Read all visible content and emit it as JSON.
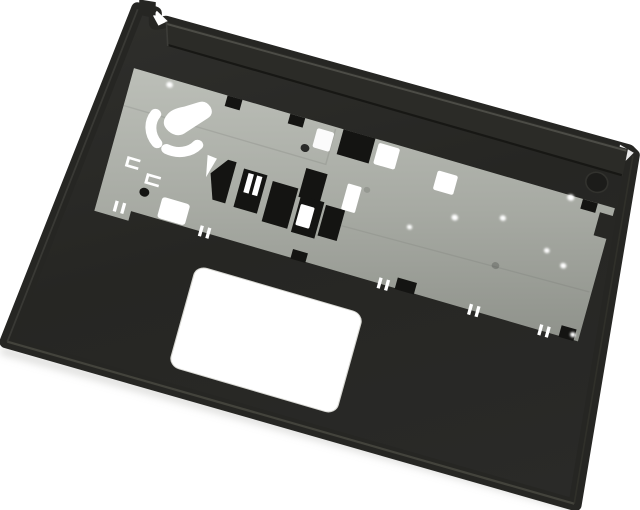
{
  "scene": {
    "alt_text": "Product photo of a black laptop palmrest top-cover assembly tilted about 16 degrees on a white background, showing a gray stamped-metal keyboard support plate with black and white cutouts, a boot-shaped cutout with two curved arc slots, screw holes, and a white rectangular touchpad opening",
    "subject": "laptop-palmrest-top-cover",
    "rotation_deg": 16.3,
    "colors": {
      "bg": "#ffffff",
      "body": "#262623",
      "body_light": "#2f2f2c",
      "body_dark": "#1e1e1c",
      "bar": "#2b2b27",
      "bar_highlight": "#50504a",
      "bar_shadow": "#141412",
      "plate_light": "#bcbfb8",
      "plate_mid": "#a7aaa3",
      "plate_dark": "#8d9089",
      "cutout": "#141412",
      "hole_white": "#ffffff",
      "edge_highlight": "#47473f",
      "shadow": "#c2c2bf"
    },
    "parts": {
      "body": "palmrest body (black plastic)",
      "ledge": "rear hinge ledge",
      "plate": "keyboard support plate (stamped metal)",
      "touchpad": "touchpad opening",
      "fan_cutout": "boot-shaped cutout with two arc slots",
      "square_cutout": "square through-hole",
      "round_recess": "round recess near top-right"
    },
    "counts": {
      "screw_dots": 8,
      "edge_slot_pairs": 5,
      "black_cutouts": 14,
      "white_cutouts": 8,
      "arc_slots": 2
    }
  }
}
